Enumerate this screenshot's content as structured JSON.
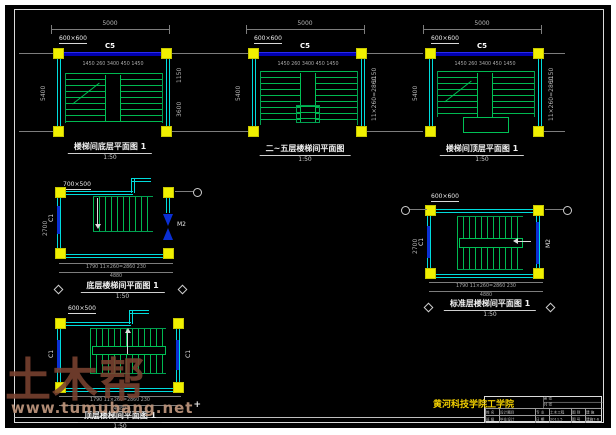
{
  "plans": [
    {
      "col_size_label": "600×600",
      "beam_label": "C5",
      "dim_top": "5000",
      "dims_under_beam": "1450 260 3400 450 1450",
      "dim_left": "5400",
      "dim_right_a": "1150",
      "dim_right_b": "3600",
      "title": "楼梯间底层平面图 1",
      "scale": "1:50"
    },
    {
      "col_size_label": "600×600",
      "beam_label": "C5",
      "dim_top": "5000",
      "dims_under_beam": "1450 260 3400 450 1450",
      "dim_left": "5400",
      "dim_right_a": "1150",
      "dim_right_b": "11×260=2860",
      "title": "二~五层楼梯间平面图",
      "scale": "1:50"
    },
    {
      "col_size_label": "600×600",
      "beam_label": "C5",
      "dim_top": "5000",
      "dims_under_beam": "1450 260 3400 450 1450",
      "dim_left": "5400",
      "dim_right_a": "1150",
      "dim_right_b": "11×260=2860",
      "title": "楼梯间顶层平面图 1",
      "scale": "1:50"
    },
    {
      "col_size_label": "700×500",
      "window_label": "C1",
      "door_label": "M2",
      "dims_bottom": "1790   11×260=2860   230",
      "dim_total": "4880",
      "dim_left": "2700",
      "title": "底层楼梯间平面图 1",
      "scale": "1:50"
    },
    {
      "col_size_label": "600×600",
      "window_label": "C1",
      "door_label": "M2",
      "dims_bottom": "1790   11×260=2860   230",
      "dim_total": "4880",
      "dim_left": "2700",
      "title": "标准层楼梯间平面图 1",
      "scale": "1:50"
    },
    {
      "col_size_label": "600×500",
      "window_label_left": "C1",
      "window_label_right": "C1",
      "dims_bottom": "1790   11×260=2860   230",
      "dim_total": "4880",
      "title": "顶层楼梯间平面图 1",
      "scale": "1:50"
    }
  ],
  "titleblock": {
    "school": "黄河科技学院工学院",
    "cells_top": [
      "第 张",
      "共 张"
    ],
    "row1": [
      "姓 名",
      "设计题目",
      "专 业",
      "土木工程",
      "图 别",
      "建 施"
    ],
    "row2": [
      "班 级",
      "毕业设计",
      "日 期",
      "2011.5",
      "图 号",
      "建施7-6"
    ]
  },
  "watermark": {
    "brand": "土木帮",
    "url": "www.tumubang.net",
    "mark": "+"
  }
}
